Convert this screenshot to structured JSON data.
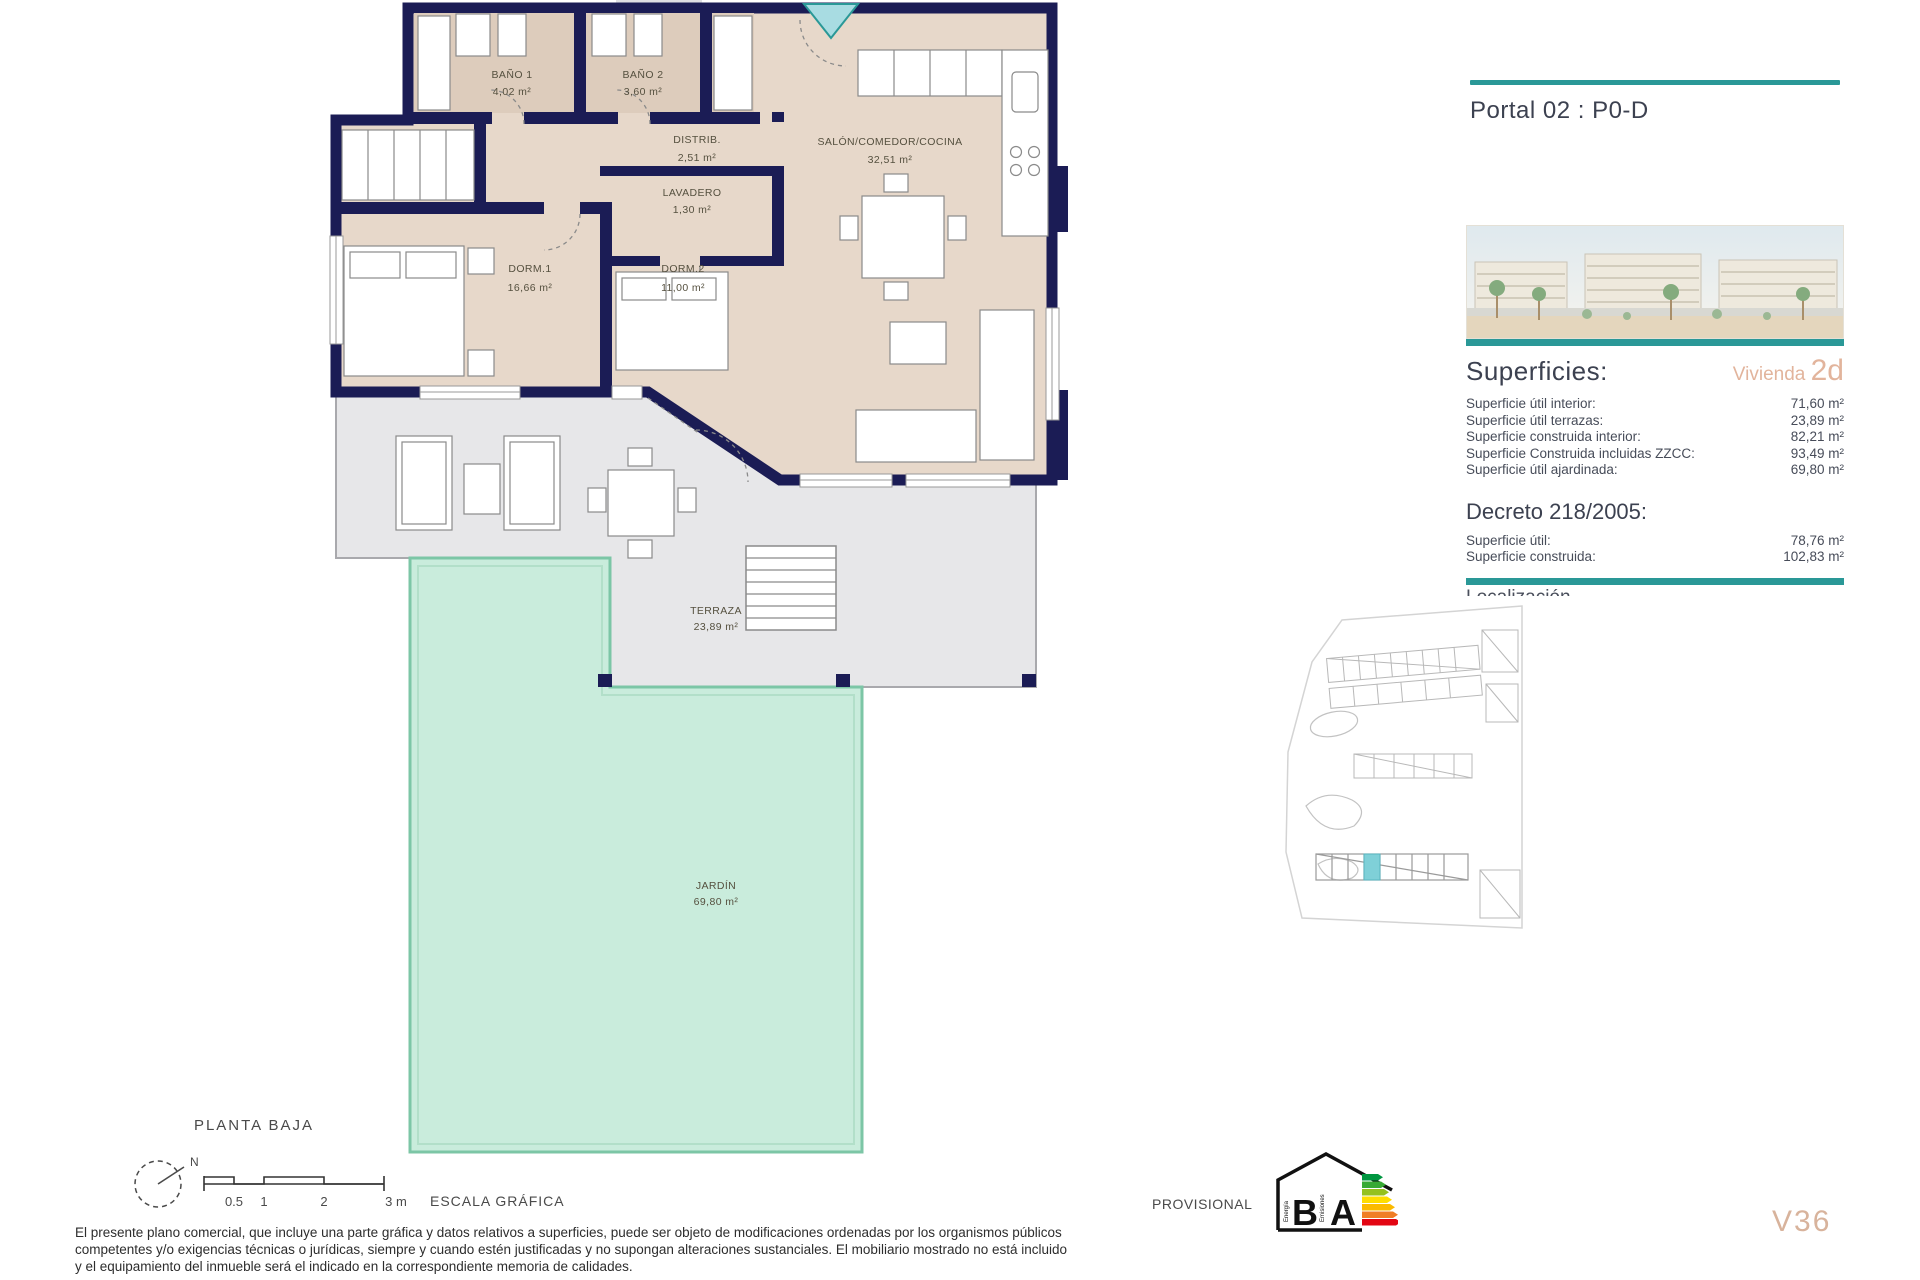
{
  "plan": {
    "title": "PLANTA BAJA",
    "rooms": [
      {
        "name": "BAÑO 1",
        "area": "4,02 m²"
      },
      {
        "name": "BAÑO 2",
        "area": "3,60 m²"
      },
      {
        "name": "DISTRIB.",
        "area": "2,51 m²"
      },
      {
        "name": "SALÓN/COMEDOR/COCINA",
        "area": "32,51 m²"
      },
      {
        "name": "LAVADERO",
        "area": "1,30 m²"
      },
      {
        "name": "DORM.1",
        "area": "16,66 m²"
      },
      {
        "name": "DORM.2",
        "area": "11,00 m²"
      },
      {
        "name": "TERRAZA",
        "area": "23,89 m²"
      },
      {
        "name": "JARDÍN",
        "area": "69,80 m²"
      }
    ],
    "compass_label": "N",
    "scale": {
      "labels": [
        "0.5",
        "1",
        "2",
        "3 m"
      ],
      "caption": "ESCALA GRÁFICA"
    }
  },
  "panel": {
    "title": "Portal 02 : P0-D",
    "superficies": {
      "heading": "Superficies:",
      "vivienda_label": "Vivienda",
      "vivienda_code": "2d",
      "rows": [
        {
          "label": "Superficie útil interior:",
          "value": "71,60 m²"
        },
        {
          "label": "Superficie útil terrazas:",
          "value": "23,89 m²"
        },
        {
          "label": "Superficie construida interior:",
          "value": "82,21 m²"
        },
        {
          "label": "Superficie Construida incluidas ZZCC:",
          "value": "93,49 m²"
        },
        {
          "label": "Superficie útil ajardinada:",
          "value": "69,80 m²"
        }
      ]
    },
    "decreto": {
      "heading": "Decreto 218/2005:",
      "rows": [
        {
          "label": "Superficie útil:",
          "value": "78,76 m²"
        },
        {
          "label": "Superficie construida:",
          "value": "102,83 m²"
        }
      ]
    },
    "clipped_heading": "Localización",
    "unit_code": "V36"
  },
  "footer": {
    "provisional": "PROVISIONAL",
    "energy": {
      "letter_b": "B",
      "letter_a": "A",
      "energia": "Energía",
      "emisiones": "Emisiones"
    },
    "disclaimer_lines": [
      "El presente plano comercial, que incluye una parte gráfica y datos relativos a superficies, puede ser objeto de modificaciones ordenadas por los organismos públicos",
      "competentes y/o exigencias técnicas o jurídicas, siempre y cuando estén justificadas y no supongan alteraciones sustanciales. El mobiliario mostrado no está incluido",
      "y el equipamiento del inmueble será el indicado en la correspondiente memoria de calidades."
    ]
  },
  "colors": {
    "accent_teal": "#2a9897",
    "wall_navy": "#1b1c55",
    "room_beige": "#e7d8ca",
    "terrace_gray": "#e7e7e9",
    "garden_mint": "#c9ecdc",
    "garden_border": "#7cc6a6",
    "highlight_salmon": "#e2b49c"
  }
}
